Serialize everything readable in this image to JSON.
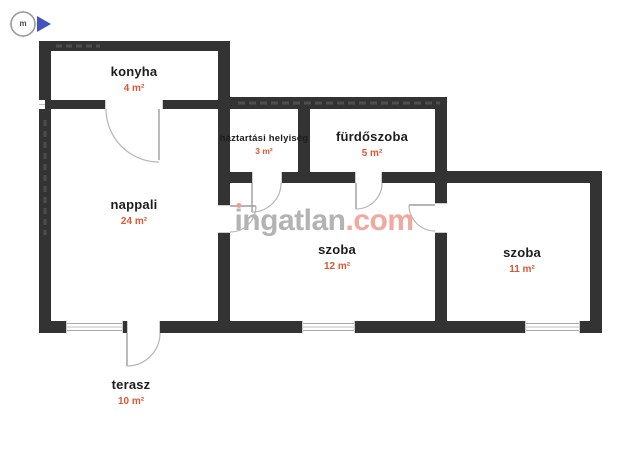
{
  "compass": {
    "label": "m",
    "arrow_color": "#4053c0"
  },
  "watermark": {
    "name": "ingatlan",
    "tld": ".com",
    "name_color": "#b3b3b3",
    "tld_color": "#f1a89e"
  },
  "rooms": [
    {
      "id": "konyha",
      "name": "konyha",
      "area": "4 m²"
    },
    {
      "id": "nappali",
      "name": "nappali",
      "area": "24 m²"
    },
    {
      "id": "haztartasi",
      "name": "háztartási helyiség",
      "area": "3 m²"
    },
    {
      "id": "furdoszoba",
      "name": "fürdőszoba",
      "area": "5 m²"
    },
    {
      "id": "szoba-12",
      "name": "szoba",
      "area": "12 m²"
    },
    {
      "id": "szoba-11",
      "name": "szoba",
      "area": "11 m²"
    },
    {
      "id": "terasz",
      "name": "terasz",
      "area": "10 m²"
    }
  ],
  "colors": {
    "wall": "#333333",
    "room_name_text": "#1d1d1d",
    "area_text": "#dd5633",
    "door_arc": "#b5b5b5",
    "window_line": "#a9a9a9"
  }
}
